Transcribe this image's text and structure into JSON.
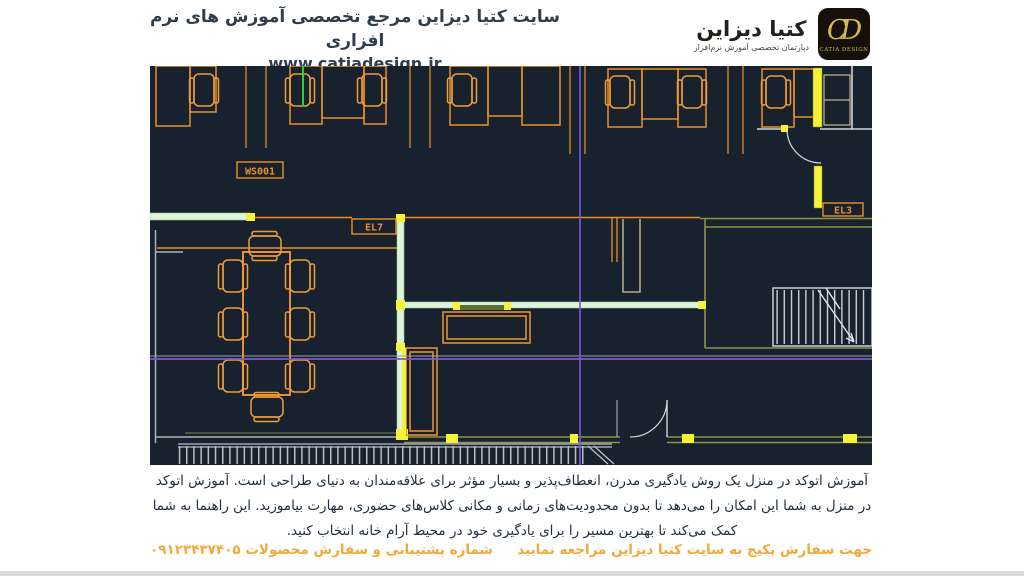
{
  "header": {
    "title": "سایت کتیا دیزاین مرجع تخصصی آموزش های نرم افزاری",
    "website": "www.catiadesign.ir",
    "brand": {
      "name_fa": "کتیا دیزاین",
      "subtitle_fa": "دپارتمان تخصصی آموزش نرم‌افزار",
      "monogram": "CD",
      "logo_caption": "CATIA DESIGN"
    }
  },
  "cad": {
    "labels": {
      "workstation": "WS001",
      "elevator7": "EL7",
      "elevator3": "EL3"
    },
    "colors": {
      "background": "#18212e",
      "furniture_orange": "#e8912c",
      "wall_light_green": "#def5d8",
      "wall_olive": "#8b9349",
      "highlight_yellow": "#f5f23a",
      "crosshair_purple": "#7e57d8",
      "line_gray": "#c9cfd8",
      "snap_green": "#2ecc40"
    }
  },
  "footer": {
    "paragraph_lines": [
      "آموزش اتوکد در منزل یک روش یادگیری مدرن، انعطاف‌پذیر و بسیار مؤثر برای علاقه‌مندان به دنیای طراحی است. آموزش اتوکد",
      "در منزل به شما این امکان را می‌دهد تا بدون محدودیت‌های زمانی و مکانی کلاس‌های حضوری، مهارت بیاموزید. این راهنما به شما",
      "کمک می‌کند تا بهترین مسیر را برای یادگیری خود در محیط آرام خانه انتخاب کنید."
    ],
    "cta_right": "جهت سفارش پکیج به سایت کتیا دیزاین مراجعه نمایید",
    "support_left": "شماره پشتیبانی و سفارش محصولات ۰۹۱۲۳۴۳۷۴۰۵"
  }
}
